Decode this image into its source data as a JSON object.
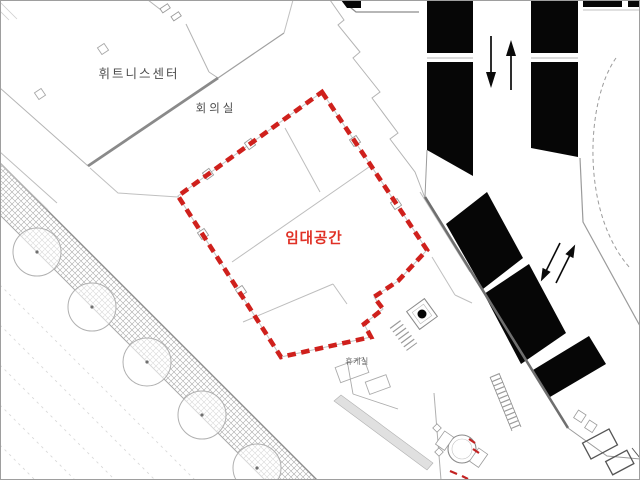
{
  "plan": {
    "labels": {
      "fitness_center": "휘트니스센터",
      "meeting_room": "회의실",
      "rental_space": "임대공간",
      "lounge": "휴게실"
    },
    "colors": {
      "highlight_red": "#cf201c",
      "label_red": "#e03126",
      "label_gray": "#4d4d4d",
      "mass_black": "#060606",
      "wall_light": "#b4b4b4",
      "wall_dark": "#8a8a8a",
      "frame": "#9e9e9e"
    }
  }
}
